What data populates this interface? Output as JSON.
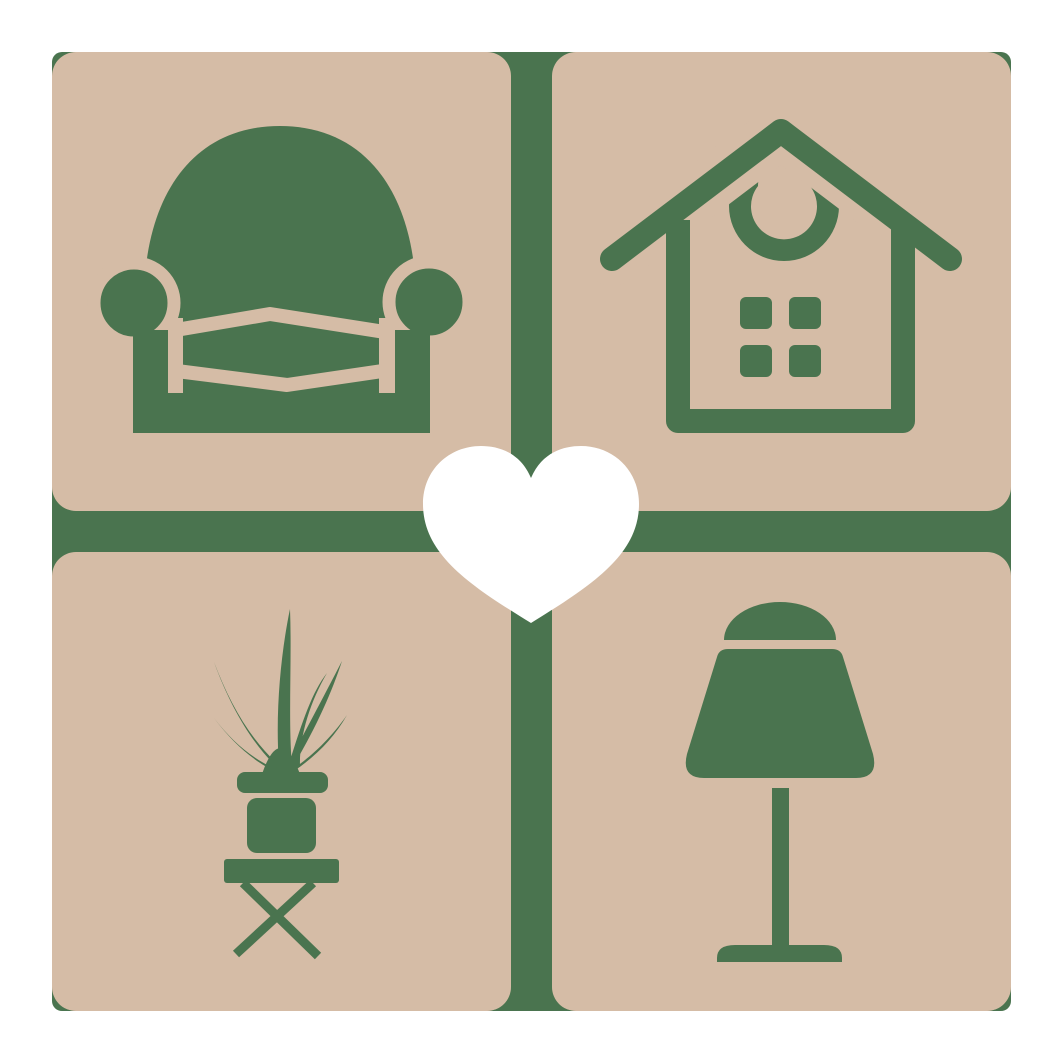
{
  "logo": {
    "background_color": "#ffffff",
    "colors": {
      "tile": "#d5bca6",
      "icon": "#4a744f",
      "heart": "#ffffff"
    },
    "tiles": [
      {
        "position": "top-left",
        "icon": "armchair-icon"
      },
      {
        "position": "top-right",
        "icon": "house-icon"
      },
      {
        "position": "bottom-left",
        "icon": "potted-plant-icon"
      },
      {
        "position": "bottom-right",
        "icon": "table-lamp-icon"
      }
    ],
    "center_icon": "heart-icon"
  }
}
